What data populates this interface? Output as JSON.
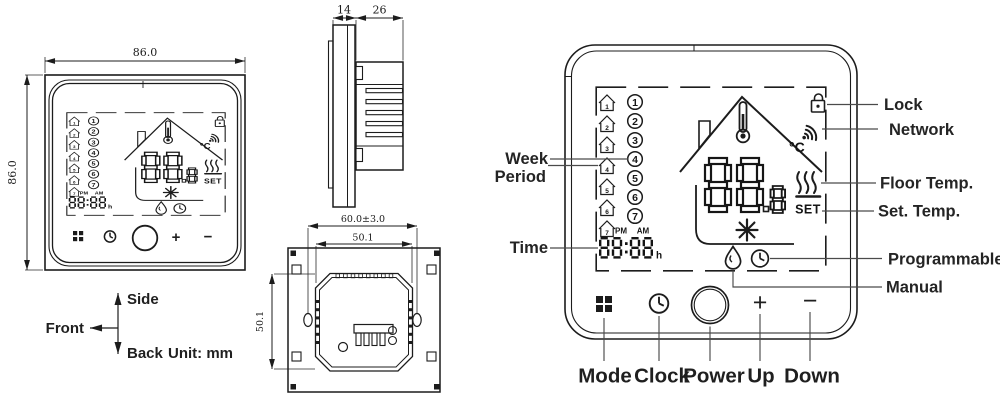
{
  "dimensions": {
    "front_width": "86.0",
    "front_height": "86.0",
    "side_depth_front": "14",
    "side_depth_back": "26",
    "back_width": "60.0±3.0",
    "back_inner_width": "50.1",
    "back_inner_height": "50.1",
    "unit": "Unit: mm"
  },
  "axes": {
    "up": "Side",
    "left": "Front",
    "down": "Back"
  },
  "lcd": {
    "week_numbers": [
      "1",
      "2",
      "3",
      "4",
      "5",
      "6",
      "7"
    ],
    "pm": "PM",
    "am": "AM",
    "time_value": "88:88",
    "time_unit": "h",
    "temp_value": "88",
    "temp_decimal": "8",
    "temp_unit": "°C",
    "set_label": "SET"
  },
  "callouts": {
    "week": "Week",
    "period": "Period",
    "time": "Time",
    "lock": "Lock",
    "network": "Network",
    "floor_temp": "Floor Temp.",
    "set_temp": "Set. Temp.",
    "programmable": "Programmable",
    "manual": "Manual"
  },
  "buttons": {
    "mode": "Mode",
    "clock": "Clock",
    "power": "Power",
    "up": "Up",
    "down": "Down",
    "up_symbol": "+",
    "down_symbol": "−"
  },
  "colors": {
    "line": "#1c1c1c",
    "background": "#ffffff"
  }
}
